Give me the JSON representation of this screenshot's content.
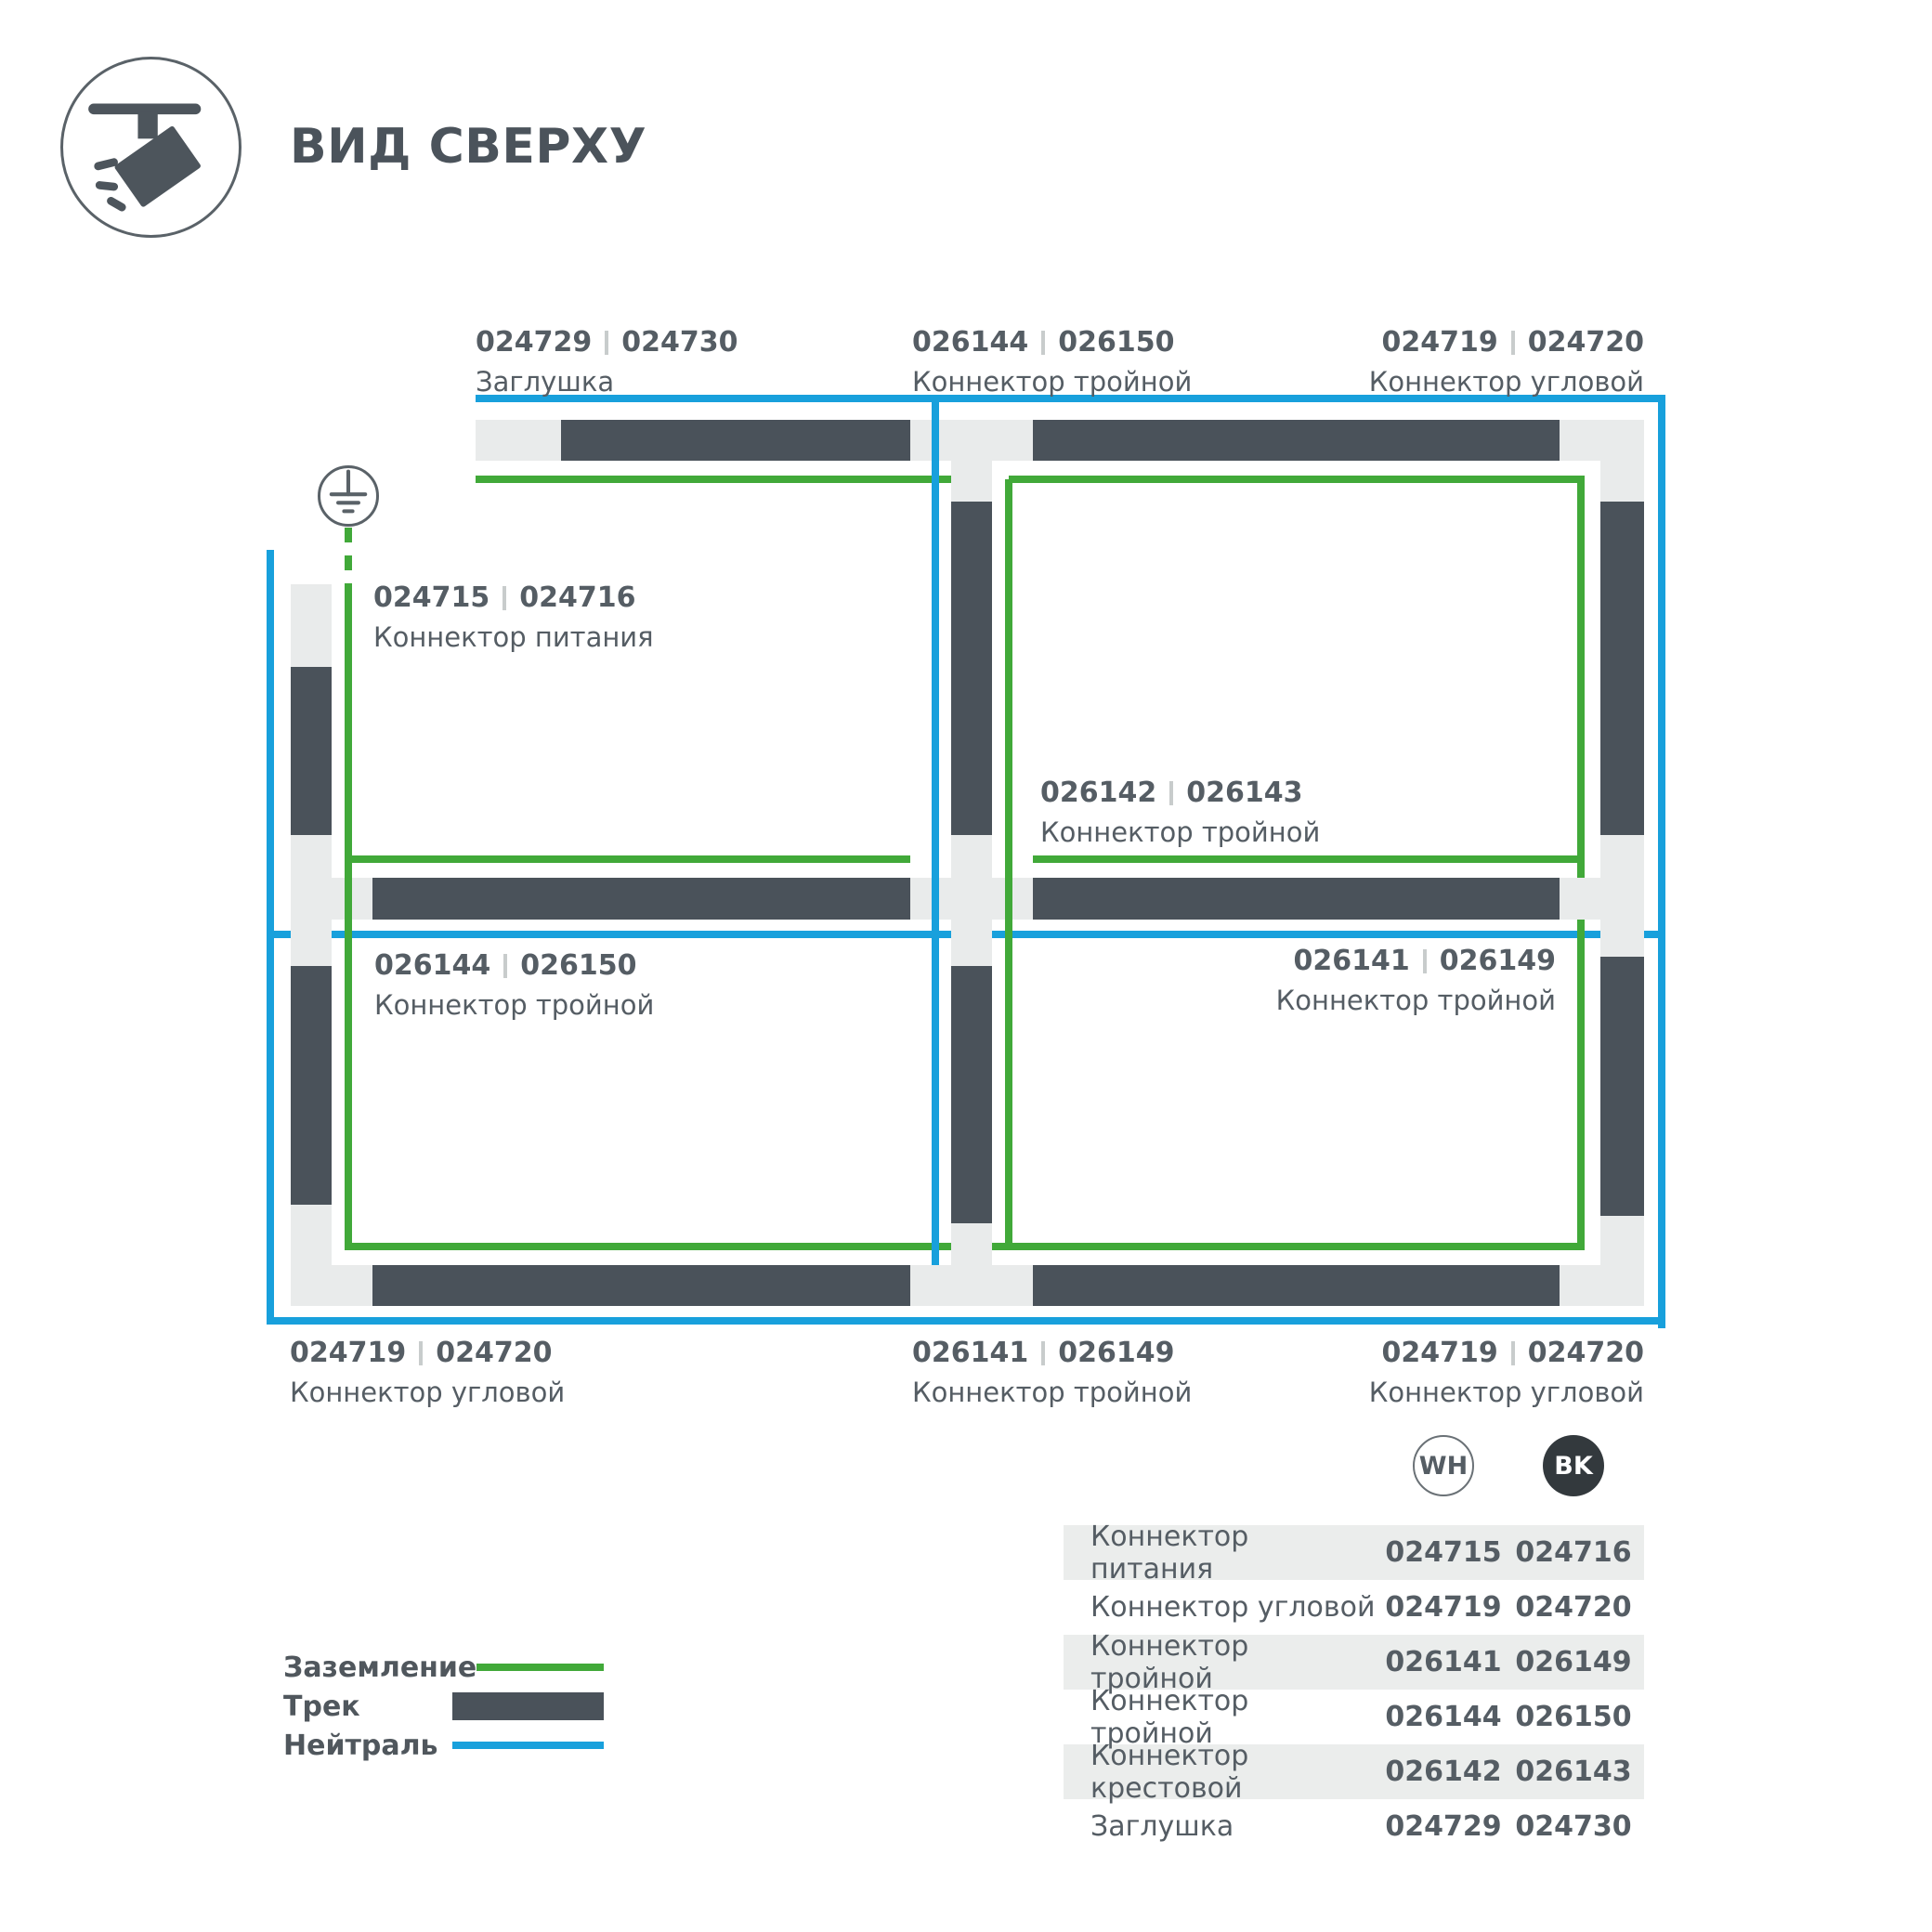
{
  "header": {
    "title": "ВИД СВЕРХУ"
  },
  "colors": {
    "track": "#4a525a",
    "connector": "#e9ebeb",
    "neutral": "#18a0dc",
    "ground": "#41a939",
    "text": "#555d64",
    "title": "#4b535b",
    "band": "#ebedec",
    "bk": "#33393d",
    "sep": "#c8cccc"
  },
  "diagram": {
    "labels": [
      {
        "code_wh": "024729",
        "code_bk": "024730",
        "name": "Заглушка"
      },
      {
        "code_wh": "026144",
        "code_bk": "026150",
        "name": "Коннектор тройной"
      },
      {
        "code_wh": "024719",
        "code_bk": "024720",
        "name": "Коннектор угловой"
      },
      {
        "code_wh": "024715",
        "code_bk": "024716",
        "name": "Коннектор питания"
      },
      {
        "code_wh": "026142",
        "code_bk": "026143",
        "name": "Коннектор тройной"
      },
      {
        "code_wh": "026144",
        "code_bk": "026150",
        "name": "Коннектор тройной"
      },
      {
        "code_wh": "026141",
        "code_bk": "026149",
        "name": "Коннектор тройной"
      },
      {
        "code_wh": "024719",
        "code_bk": "024720",
        "name": "Коннектор угловой"
      },
      {
        "code_wh": "026141",
        "code_bk": "026149",
        "name": "Коннектор тройной"
      },
      {
        "code_wh": "024719",
        "code_bk": "024720",
        "name": "Коннектор угловой"
      }
    ]
  },
  "legend": {
    "items": [
      {
        "label": "Заземление",
        "type": "ground"
      },
      {
        "label": "Трек",
        "type": "track"
      },
      {
        "label": "Нейтраль",
        "type": "neutral"
      }
    ]
  },
  "table": {
    "header": {
      "wh": "WH",
      "bk": "BK"
    },
    "rows": [
      {
        "label": "Коннектор питания",
        "wh": "024715",
        "bk": "024716"
      },
      {
        "label": "Коннектор угловой",
        "wh": "024719",
        "bk": "024720"
      },
      {
        "label": "Коннектор тройной",
        "wh": "026141",
        "bk": "026149"
      },
      {
        "label": "Коннектор тройной",
        "wh": "026144",
        "bk": "026150"
      },
      {
        "label": "Коннектор крестовой",
        "wh": "026142",
        "bk": "026143"
      },
      {
        "label": "Заглушка",
        "wh": "024729",
        "bk": "024730"
      }
    ]
  }
}
